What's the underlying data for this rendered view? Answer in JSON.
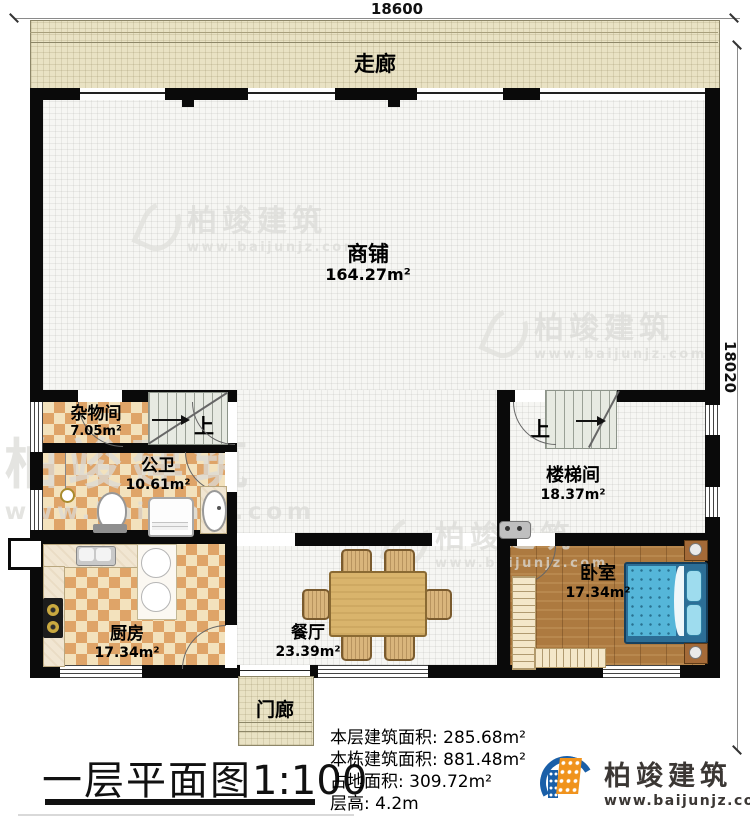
{
  "dimensions": {
    "width_label": "18600",
    "height_label": "18020"
  },
  "rooms": {
    "corridor": {
      "label": "走廊"
    },
    "shop": {
      "label": "商铺",
      "area": "164.27m²"
    },
    "storage": {
      "label": "杂物间",
      "area": "7.05m²"
    },
    "bathroom": {
      "label": "公卫",
      "area": "10.61m²"
    },
    "kitchen": {
      "label": "厨房",
      "area": "17.34m²"
    },
    "dining": {
      "label": "餐厅",
      "area": "23.39m²"
    },
    "stairwell": {
      "label": "楼梯间",
      "area": "18.37m²"
    },
    "bedroom": {
      "label": "卧室",
      "area": "17.34m²"
    },
    "porch": {
      "label": "门廊"
    }
  },
  "stairs": {
    "up1": "上",
    "up2": "上"
  },
  "title": {
    "text": "一层平面图",
    "scale": "1:100"
  },
  "stats": {
    "line1_label": "本层建筑面积:",
    "line1_value": "285.68m²",
    "line2_label": "本栋建筑面积:",
    "line2_value": "881.48m²",
    "line3_label": "占地面积:",
    "line3_value": "309.72m²",
    "line4_label": "层高:",
    "line4_value": "4.2m"
  },
  "logo": {
    "name": "柏竣建筑",
    "url": "www.baijunjz.com"
  },
  "watermark": {
    "name": "柏竣建筑",
    "url": "www.baijunjz.com"
  },
  "colors": {
    "wall": "#0a0a0a",
    "checker": "#dfa468",
    "corridor": "#e9e2c4",
    "wood": "#ad7a40",
    "bed": "#55b6d9",
    "logo_blue": "#1a5fa8",
    "logo_orange": "#f0931d"
  }
}
